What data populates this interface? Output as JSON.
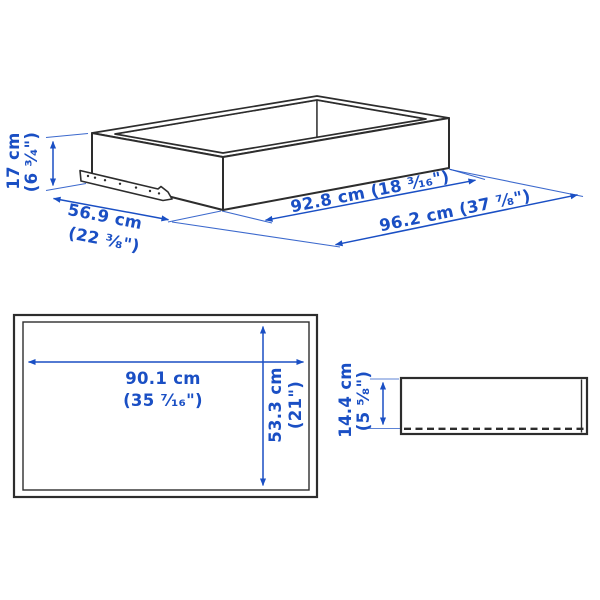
{
  "colors": {
    "dimension_blue": "#1a4fc4",
    "outline_dark": "#2d2d2d",
    "background": "#ffffff"
  },
  "isometric": {
    "height": {
      "line1": "17 cm",
      "line2": "(6 ³⁄₄\")"
    },
    "depth": {
      "line1": "56.9 cm",
      "line2": "(22 ³⁄₈\")"
    },
    "inner_width": {
      "label": "92.8 cm (18 ³⁄₁₆\")"
    },
    "total_width": {
      "label": "96.2 cm (37 ⁷⁄₈\")"
    }
  },
  "plan": {
    "width": {
      "line1": "90.1 cm",
      "line2": "(35 ⁷⁄₁₆\")"
    },
    "depth": {
      "line1": "53.3 cm",
      "line2": "(21\")"
    }
  },
  "front": {
    "height": {
      "line1": "14.4 cm",
      "line2": "(5 ⁵⁄₈\")"
    }
  }
}
